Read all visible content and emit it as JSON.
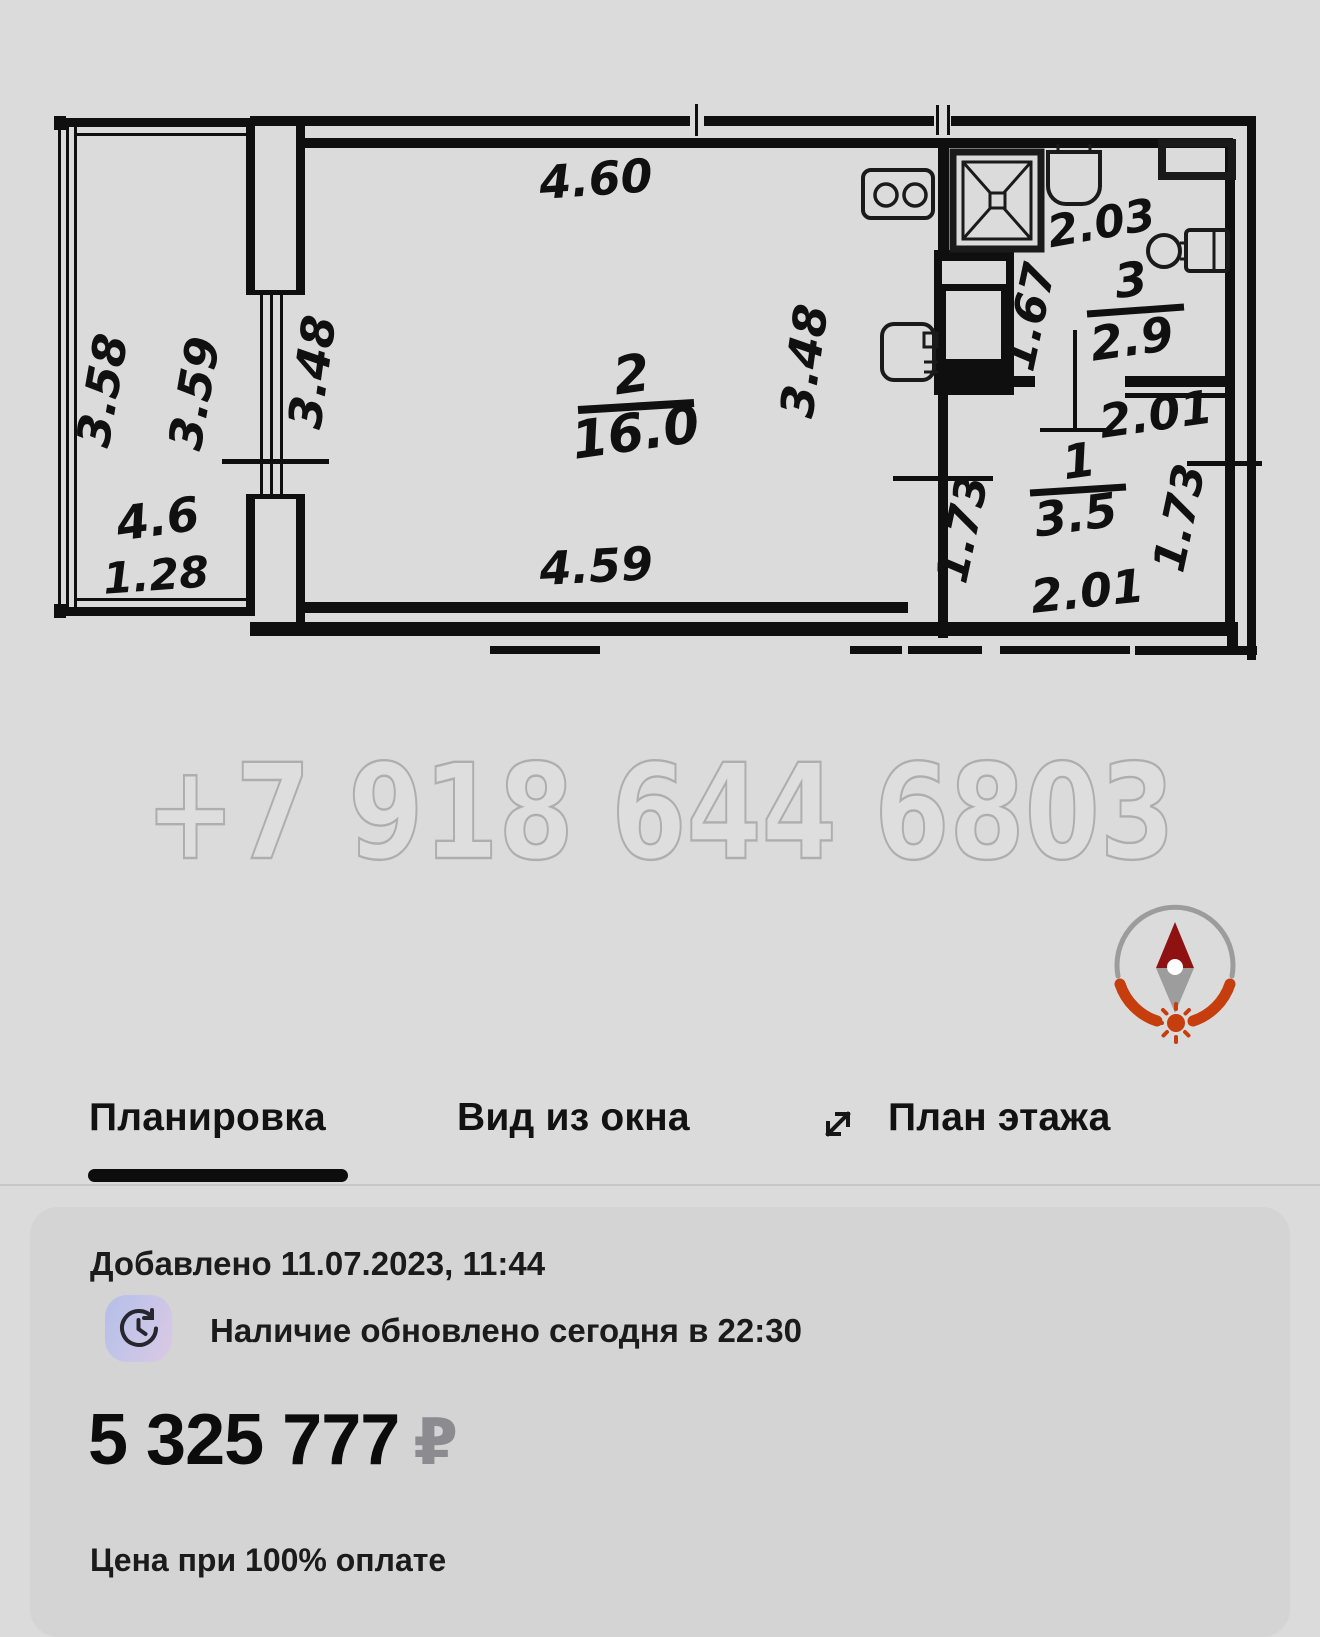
{
  "watermark": "+7 918 644 6803",
  "plan_labels": {
    "balcony_left": "3.58",
    "balcony_right": "3.59",
    "balcony_area": "4.6",
    "balcony_width": "1.28",
    "room2_top": "4.60",
    "room2_bottom": "4.59",
    "room2_left": "3.48",
    "room2_right": "3.48",
    "room2_number": "2",
    "room2_area": "16.0",
    "bath_top": "2.03",
    "bath_left": "1.67",
    "bath_number": "3",
    "bath_area": "2.9",
    "hall_top": "2.01",
    "hall_bottom": "2.01",
    "hall_left": "1.73",
    "hall_right": "1.73",
    "hall_number": "1",
    "hall_area": "3.5"
  },
  "tabs": [
    {
      "label": "Планировка",
      "active": true
    },
    {
      "label": "Вид из окна",
      "active": false
    },
    {
      "label": "План этажа",
      "active": false
    }
  ],
  "listing": {
    "added": "Добавлено 11.07.2023, 11:44",
    "availability": "Наличие обновлено сегодня в 22:30",
    "price": "5 325 777",
    "currency": "₽",
    "price_note": "Цена при 100% оплате"
  },
  "colors": {
    "compass_accent": "#c63d0e",
    "compass_needle": "#8e1212",
    "active_tab_underline": "#0d0d0d",
    "price_currency_gray": "#8b8b90"
  }
}
